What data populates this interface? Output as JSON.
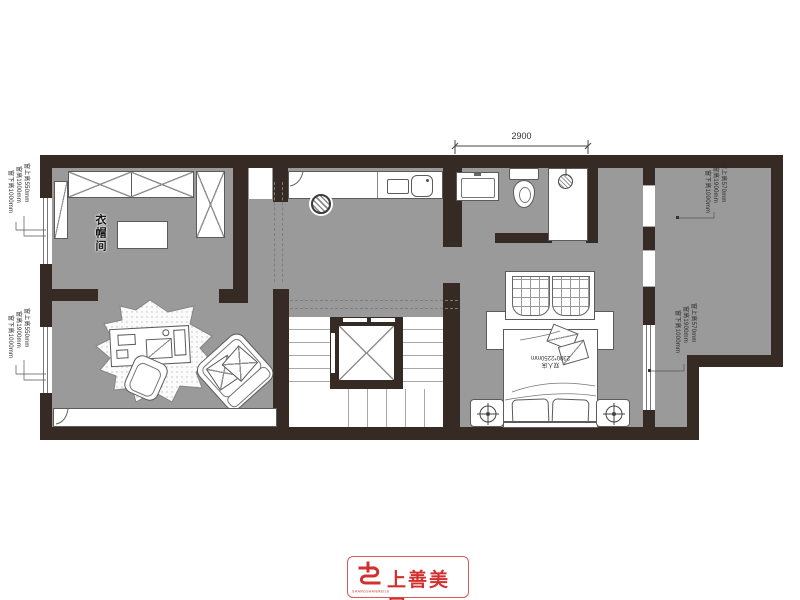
{
  "plan": {
    "dimension_top": "2900",
    "room_labels": {
      "cloakroom": "衣帽间"
    },
    "bed_label": {
      "line1": "2300*2250mm",
      "line2": "双人床"
    },
    "window_annotations": {
      "left_top": [
        "窗下高1000mm",
        "窗高1900mm",
        "窗上高550mm"
      ],
      "left_bottom": [
        "窗下高1000mm",
        "窗高1900mm",
        "窗上高550mm"
      ],
      "right_top": [
        "窗下高1000mm",
        "窗高1900mm",
        "窗上高570mm"
      ],
      "right_mid": [
        "窗下高1000mm",
        "窗高1900mm",
        "窗上高570mm"
      ]
    }
  },
  "logo": {
    "name": "上善美居",
    "sub": "SHANGSHANMEIJU"
  },
  "colors": {
    "wall": "#362a24",
    "floor": "#9a9a9a",
    "accent_red": "#d2302e"
  }
}
